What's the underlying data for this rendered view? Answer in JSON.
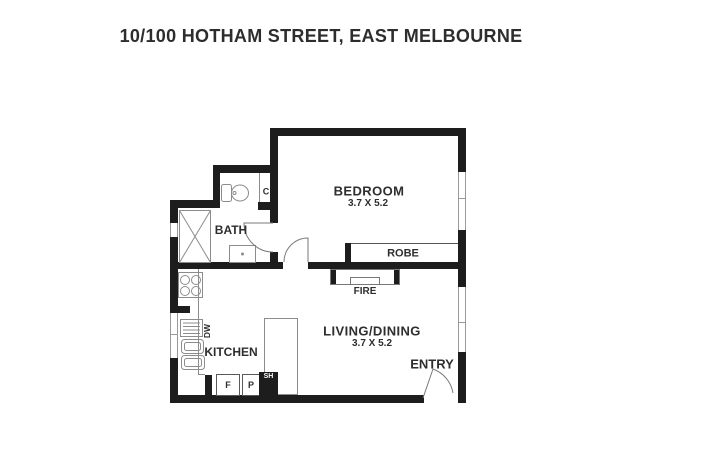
{
  "title": "10/100 HOTHAM STREET, EAST MELBOURNE",
  "rooms": {
    "bedroom": {
      "name": "BEDROOM",
      "dimensions": "3.7 X 5.2"
    },
    "living_dining": {
      "name": "LIVING/DINING",
      "dimensions": "3.7 X 5.2"
    },
    "bath": {
      "name": "BATH"
    },
    "kitchen": {
      "name": "KITCHEN"
    },
    "entry": {
      "name": "ENTRY"
    }
  },
  "labels": {
    "robe": "ROBE",
    "fire": "FIRE",
    "dishwasher": "DW",
    "fridge": "F",
    "pantry": "P",
    "shelf": "SH",
    "cupboard": "C"
  },
  "colors": {
    "wall": "#1d1d1d",
    "fixture_line": "#8c8c8c",
    "text": "#2e2e2e",
    "background": "#ffffff"
  }
}
